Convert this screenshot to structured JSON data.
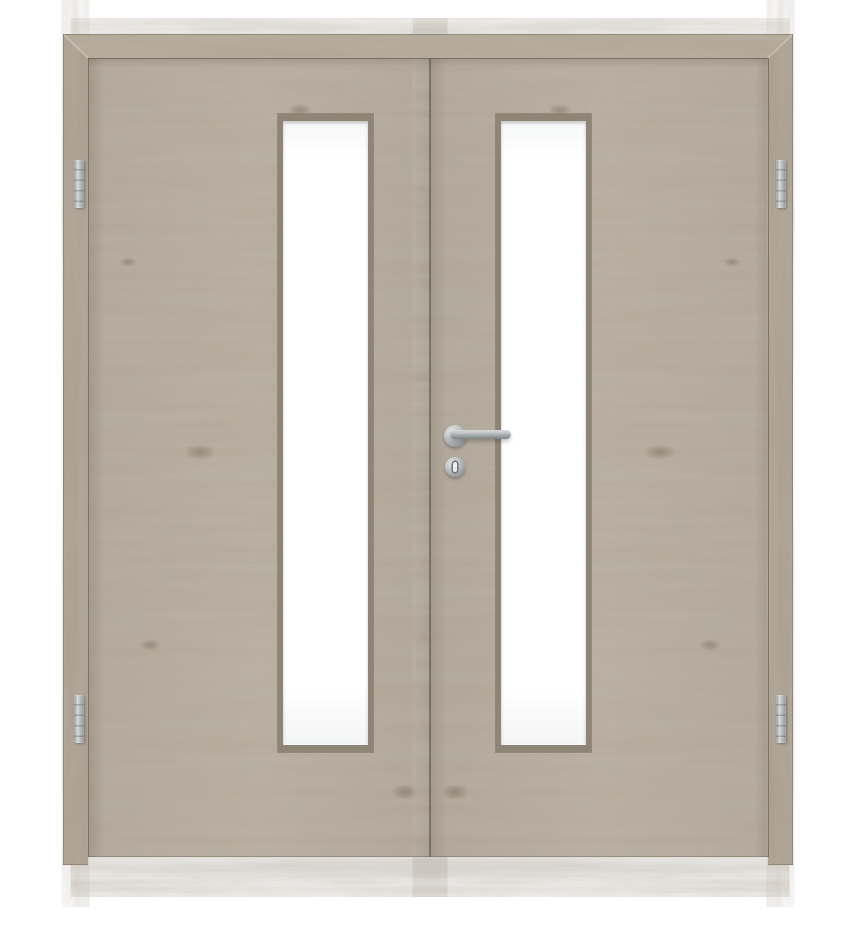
{
  "meta": {
    "type": "product-photo",
    "subject": "Double-leaf interior door with frame, wood decor finish, two vertical glass lites and stainless hardware",
    "background": "white studio"
  },
  "door": {
    "finish_name": "grey oak woodgrain decor",
    "leaf_count": 2,
    "grain": {
      "leaves": "horizontal grain with knots, mirrored at the central meeting stile",
      "frame": "vertical grain jambs with mitred head-frame corners"
    },
    "frame": {
      "style": "block frame, mitred top corners, jamb feet extend slightly below leaves"
    },
    "glass": {
      "count": 2,
      "style": "one tall narrow vertical lite per leaf",
      "finish": "opaque white / frosted glazing",
      "bead": "matching wood glazing bead with bevel"
    },
    "hinges": {
      "count": 4,
      "finish": "brushed stainless steel",
      "layout": "two per leaf, mounted on outer jambs (top and bottom)"
    },
    "handle": {
      "type": "lever handle on round rosette",
      "finish": "brushed stainless steel",
      "orientation": "horizontal, pointing right, mounted on right leaf at the meeting stile",
      "escutcheon": "round key rosette with keyhole below the lever"
    }
  },
  "colors": {
    "wood_base": "#b6ab9c",
    "wood_frame": "#a99e8e",
    "wood_lintel": "#b0a595",
    "bead": "#8f8577",
    "glass_white": "#ffffff",
    "metal_light": "#d9dcdd",
    "metal_mid": "#adb2b3",
    "metal_dark": "#7e8385",
    "gap_line": "rgba(90,78,62,0.55)",
    "background": "#ffffff",
    "floor_shadow": "rgba(85,75,62,0.13)"
  }
}
